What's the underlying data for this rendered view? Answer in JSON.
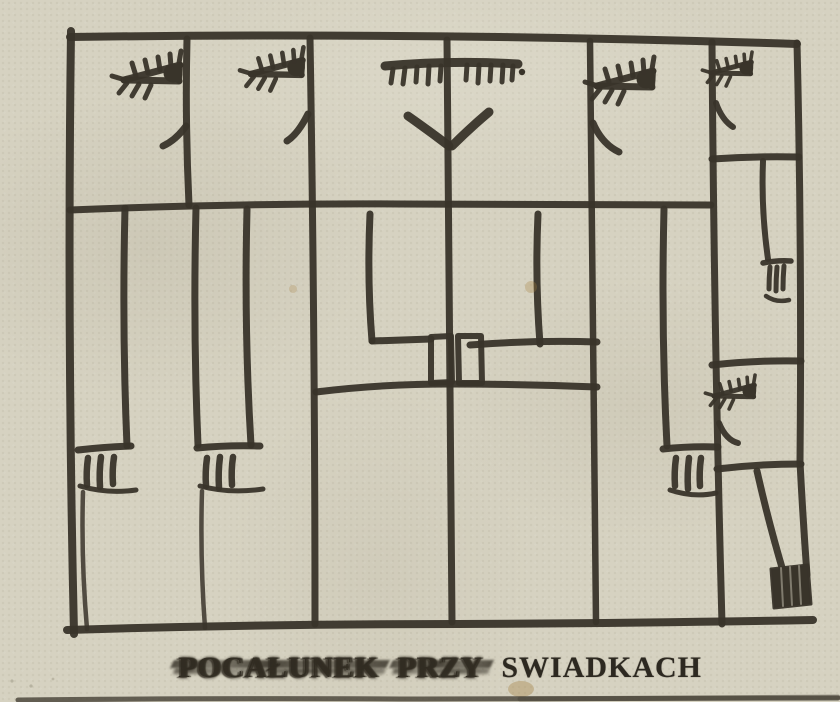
{
  "artwork": {
    "caption": {
      "words": [
        {
          "text": "POCAŁUNEK",
          "smudged": true
        },
        {
          "text": "PRZY",
          "smudged": true
        },
        {
          "text": "SWIADKACH",
          "smudged": false
        }
      ]
    },
    "colors": {
      "paper": "#d6d2c1",
      "ink": "#39342a",
      "caption_ink": "#2d2921"
    },
    "illustration": {
      "icons": [
        "eye-icon",
        "closed-eyes-icon",
        "kiss-lips-icon",
        "foot-toes-icon",
        "hand-fingers-icon",
        "boot-icon"
      ],
      "figures": [
        "witness-1",
        "witness-2",
        "kissing-couple",
        "witness-3",
        "witness-4-small",
        "witness-5-small"
      ]
    }
  }
}
